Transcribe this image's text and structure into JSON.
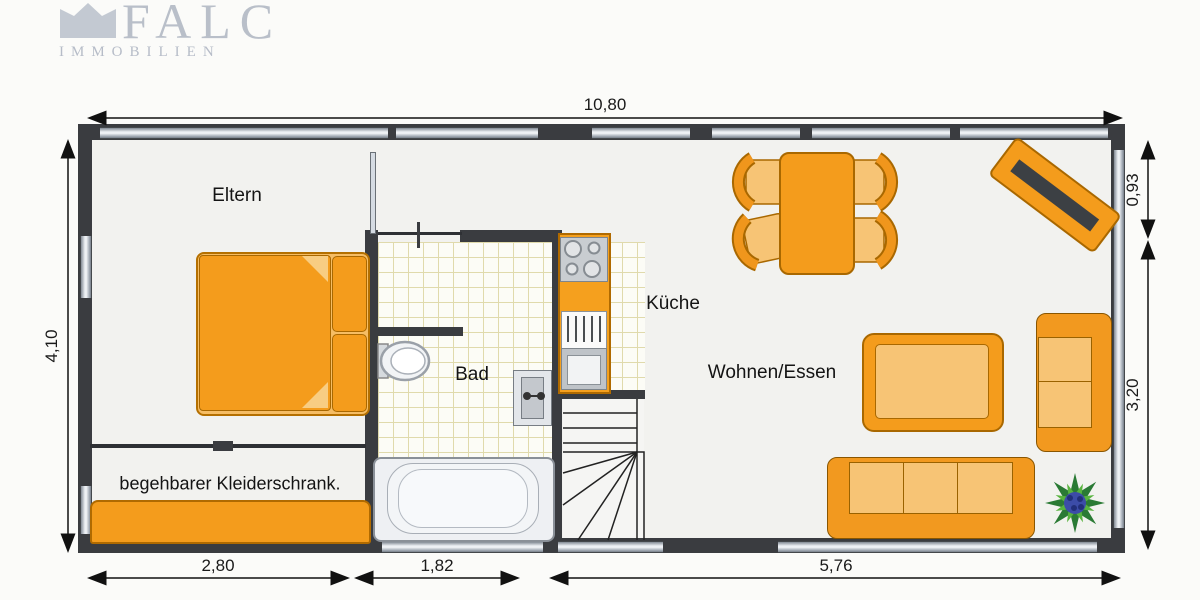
{
  "logo": {
    "name": "FALC",
    "subtitle": "IMMOBILIEN"
  },
  "rooms": {
    "parents": "Eltern",
    "bath": "Bad",
    "kitchen": "Küche",
    "living": "Wohnen/Essen",
    "closet": "begehbarer Kleiderschrank."
  },
  "dimensions": {
    "top": "10,80",
    "left": "4,10",
    "right_upper": "0,93",
    "right_lower": "3,20",
    "bottom_left": "2,80",
    "bottom_middle": "1,82",
    "bottom_right": "5,76"
  },
  "colors": {
    "furniture_orange": "#f49c1c",
    "furniture_light": "#f7c475",
    "wall": "#3a3c40",
    "tile_line": "#e0daac",
    "window_glass": "#e9edf1",
    "logo_gray": "#b9bfc9",
    "plant_green": "#2a7a34",
    "plant_blue": "#3c4ca8"
  }
}
